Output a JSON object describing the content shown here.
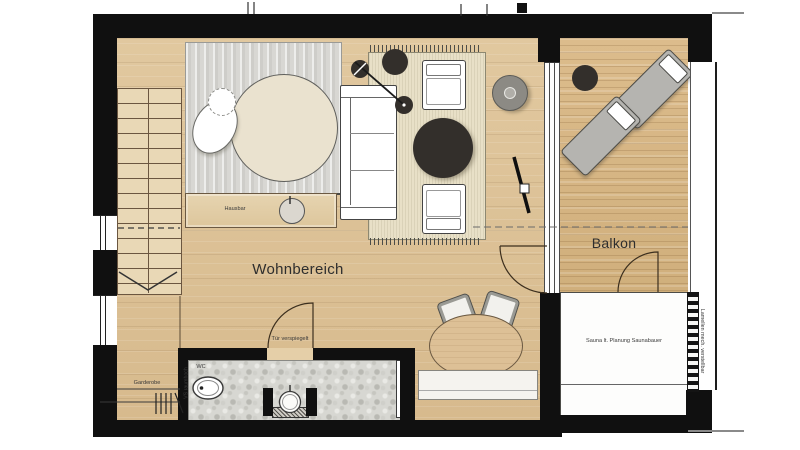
{
  "rooms": {
    "living": "Wohnbereich",
    "balcony": "Balkon"
  },
  "annotations": {
    "hausbar": "Hausbar",
    "wardrobe": "Garderobe",
    "wc": "WC",
    "mirrored_door": "Tür verspiegelt",
    "vs_full_height": "VS raumhoch",
    "sauna_note": "Sauna lt. Planung Saunabauer",
    "louvers_note": "Lamellen mech. verstellbar"
  },
  "colors": {
    "wall": "#101010",
    "wood_floor": "#dcc094",
    "balcony_floor": "#d5b484",
    "sleeping_rug": "#d8d7d3",
    "living_rug": "#e8e0c7",
    "stone_floor": "#d7d7d2",
    "dark_furniture": "#332f2b",
    "lounger_gray": "#b5b4b0",
    "sauna_fill": "#fdfdfc"
  }
}
